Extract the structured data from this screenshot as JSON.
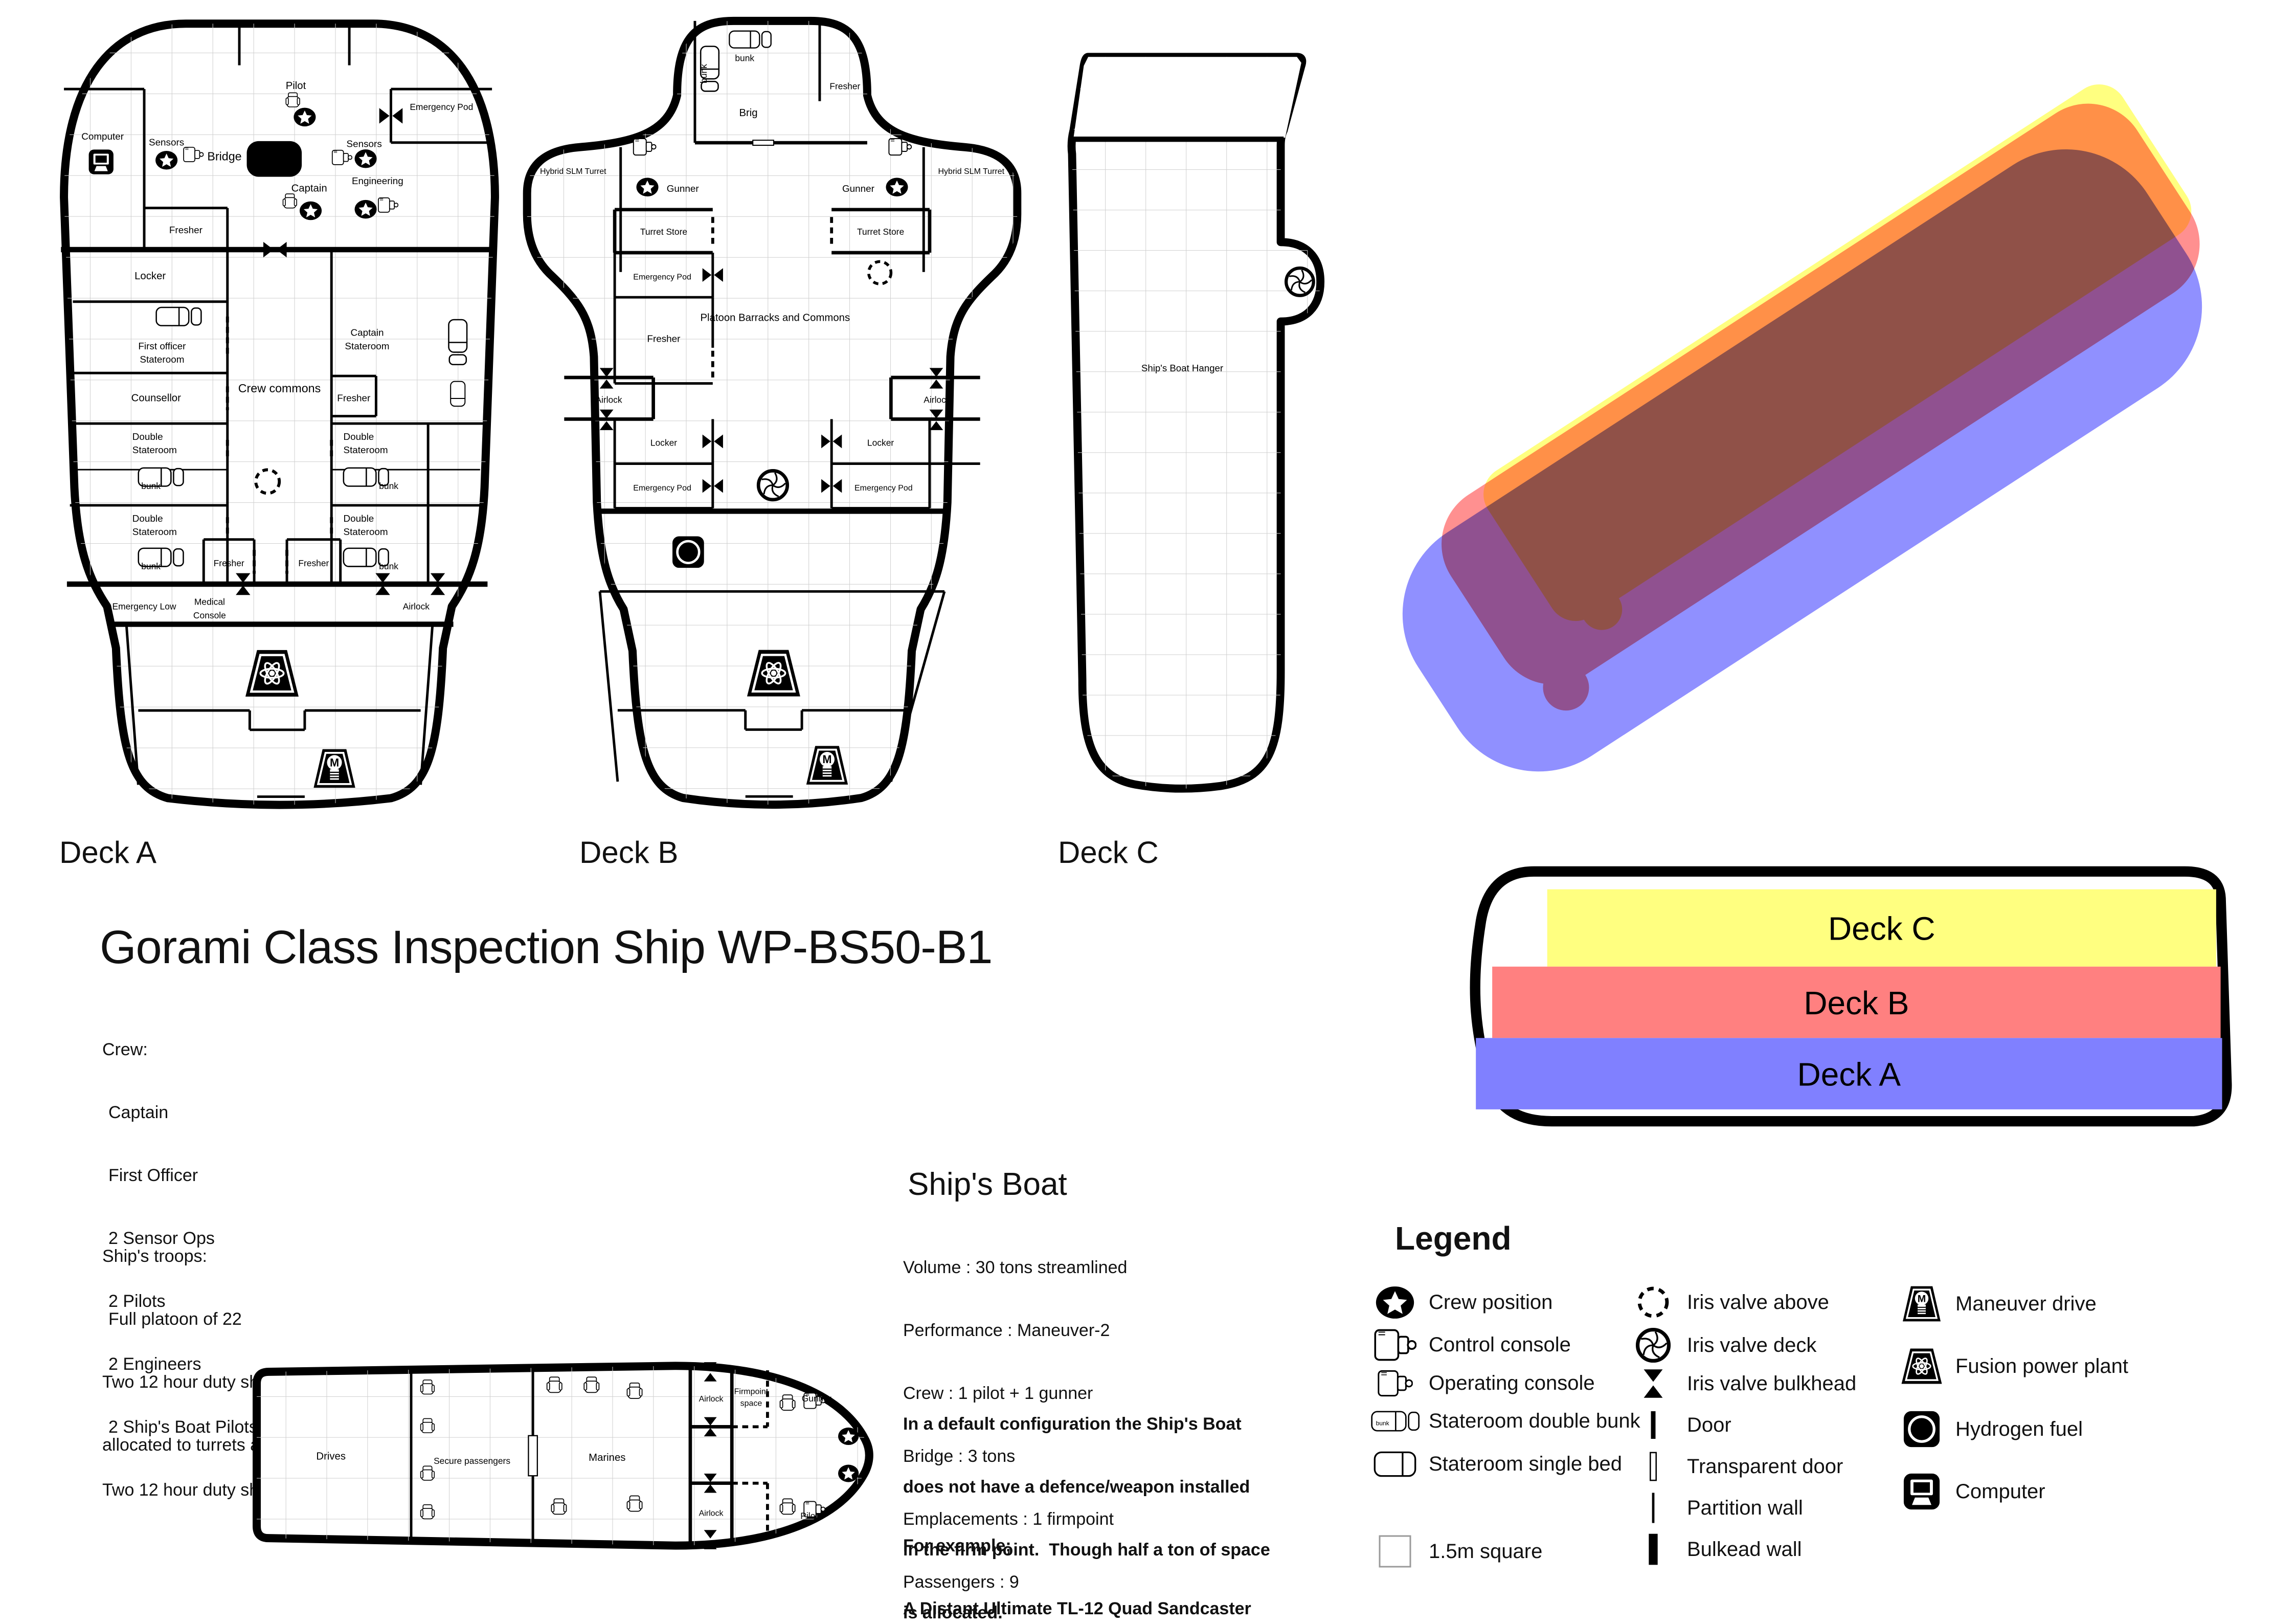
{
  "page": {
    "title": "Gorami Class Inspection Ship WP-BS50-B1"
  },
  "deck_captions": {
    "a": "Deck A",
    "b": "Deck B",
    "c": "Deck C"
  },
  "deck_stack": {
    "deck_c": "Deck C",
    "deck_b": "Deck B",
    "deck_a": "Deck A"
  },
  "colors": {
    "deck_a_blue": "#9090ff",
    "deck_b_red": "#ff9090",
    "deck_c_yellow": "#ffff80",
    "stack_blue": "#8080ff",
    "stack_red": "#ff8080",
    "stack_yellow": "#ffff80",
    "wall": "#000000",
    "grid": "#cfcfcf"
  },
  "labels": {
    "sensors": "Sensors",
    "bridge": "Bridge",
    "pilot": "Pilot",
    "emergency_pod": "Emergency Pod",
    "computer": "Computer",
    "plotting_table": "Plotting table",
    "captain": "Captain",
    "engineering": "Engineering",
    "fresher": "Fresher",
    "locker": "Locker",
    "first_officer": "First officer",
    "stateroom": "Stateroom",
    "counsellor": "Counsellor",
    "crew_commons": "Crew commons",
    "double": "Double",
    "bunk": "bunk",
    "emergency_low": "Emergency Low",
    "medical": "Medical",
    "console_word": "Console",
    "airlock": "Airlock",
    "hybrid_slm_turret": "Hybrid SLM Turret",
    "gunner": "Gunner",
    "turret_store": "Turret Store",
    "brig": "Brig",
    "platoon_barracks": "Platoon Barracks and Commons",
    "ships_boat_hanger": "Ship's Boat Hanger",
    "drives": "Drives",
    "secure_passengers": "Secure passengers",
    "marines": "Marines",
    "firmpoint": "Firmpoint",
    "space": "space",
    "maneuver_m": "M",
    "hydrogen_h": "H"
  },
  "crew": {
    "heading": "Crew:",
    "items": [
      "Captain",
      "First Officer",
      "2 Sensor Ops",
      "2 Pilots",
      "2 Engineers",
      "2 Ship's Boat Pilots (also work 2nd sensor ops)"
    ],
    "footer": "Two 12 hour duty shifts of 5 crew"
  },
  "troops": {
    "heading": "Ship's troops:",
    "item": "Full platoon of 22",
    "line1": "Two 12 hour duty shifts of 1 officer and two squads of 5",
    "line2": "allocated to turrets and boarding/inspection"
  },
  "ships_boat": {
    "heading": "Ship's Boat",
    "stats": [
      "Volume : 30 tons streamlined",
      "Performance : Maneuver-2",
      "Crew : 1 pilot + 1 gunner",
      "Bridge : 3 tons",
      "Emplacements : 1 firmpoint",
      "Passengers : 9",
      "Cost : 6 MCr"
    ],
    "para1": [
      "In a default configuration the Ship's Boat",
      "does not have a defence/weapon installed",
      "in the firm point.  Though half a ton of space",
      "is allocated."
    ],
    "para2": [
      "For example;",
      "A Distant Ultimate TL-12 Quad Sandcaster",
      "could be installed at an additional cost of 1.05MCr."
    ]
  },
  "legend": {
    "heading": "Legend",
    "col1": [
      {
        "icon": "crew-position-icon",
        "label": "Crew position"
      },
      {
        "icon": "control-console-icon",
        "label": "Control console"
      },
      {
        "icon": "operating-console-icon",
        "label": "Operating console"
      },
      {
        "icon": "stateroom-double-bunk-icon",
        "label": "Stateroom double bunk"
      },
      {
        "icon": "stateroom-single-bed-icon",
        "label": "Stateroom single bed"
      },
      {
        "icon": "grid-square-icon",
        "label": "1.5m square"
      }
    ],
    "col2": [
      {
        "icon": "iris-valve-above-icon",
        "label": "Iris valve above"
      },
      {
        "icon": "iris-valve-deck-icon",
        "label": "Iris valve deck"
      },
      {
        "icon": "iris-valve-bulkhead-icon",
        "label": "Iris valve bulkhead"
      },
      {
        "icon": "door-icon",
        "label": "Door"
      },
      {
        "icon": "transparent-door-icon",
        "label": "Transparent door"
      },
      {
        "icon": "partition-wall-icon",
        "label": "Partition wall"
      },
      {
        "icon": "bulkhead-wall-icon",
        "label": "Bulkead wall"
      }
    ],
    "col3": [
      {
        "icon": "maneuver-drive-icon",
        "label": "Maneuver drive"
      },
      {
        "icon": "fusion-power-plant-icon",
        "label": "Fusion power plant"
      },
      {
        "icon": "hydrogen-fuel-icon",
        "label": "Hydrogen fuel"
      },
      {
        "icon": "computer-icon",
        "label": "Computer"
      }
    ]
  }
}
